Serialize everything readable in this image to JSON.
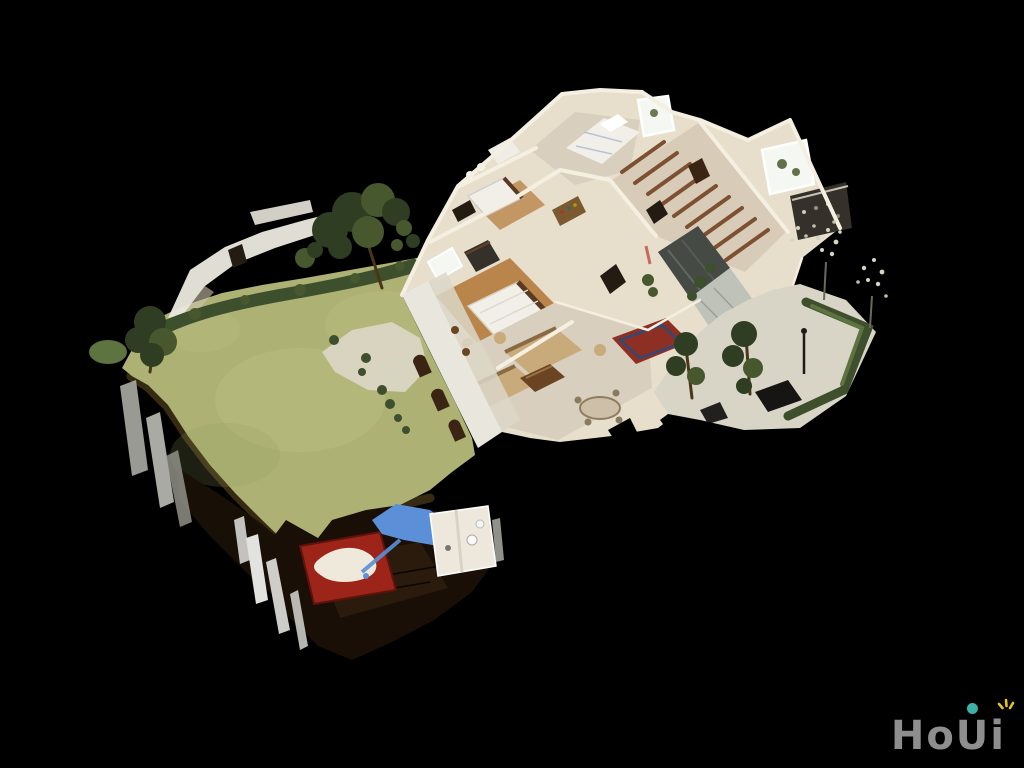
{
  "page": {
    "background": "#000000"
  },
  "viewer": {
    "scene_label": "3D dollhouse view of a scanned single-story home with backyard lawn, cutaway interior rooms and side garden",
    "regions": [
      "backyard-lawn",
      "hedgerow",
      "perimeter-wall",
      "arched-loggia",
      "master-bedroom",
      "guest-bedroom",
      "beamed-hallway",
      "mirrored-closet",
      "bathroom",
      "living-room",
      "entry-rug",
      "right-garden",
      "courtyard-tree",
      "wood-deck",
      "red-carpet",
      "blue-tarp",
      "small-bathroom"
    ]
  },
  "logo": {
    "text": "HoUi",
    "letters": [
      "H",
      "o",
      "U",
      "i"
    ]
  },
  "colors": {
    "bg": "#000000",
    "lawn": "#adb274",
    "lawn-light": "#c6c68c",
    "lawn-dark": "#8f9a58",
    "hedge": "#3d4f2c",
    "hedge-light": "#5d7340",
    "tree": "#2f3d22",
    "tree-mid": "#47582e",
    "trunk": "#4a3518",
    "wall-white": "#e9e6dd",
    "wall-cream": "#e7dfcc",
    "wall-line": "#f4efe1",
    "wall-shadow": "#cfc3ab",
    "floor-wood": "#b9854a",
    "carpet": "#d9cfbe",
    "hall-floor": "#d8ccb8",
    "stone": "#dbd7c8",
    "gravel": "#d9d5c6",
    "beam": "#7c5030",
    "bed-white": "#f1efe7",
    "sofa": "#c9aa7a",
    "sofa-dark": "#8a6a42",
    "table-wood": "#6b4423",
    "rug-red": "#8e2f23",
    "rug-blue": "#2f4a78",
    "mirror": "#454a44",
    "marble": "#bfc2b8",
    "deck": "#190f07",
    "deck-light": "#30200f",
    "soil": "#3a2c14",
    "moss": "#6a6a34",
    "red-carpet": "#9c2418",
    "blob-white": "#efe9dc",
    "tarp-blue": "#5b8fd8",
    "bath-white": "#eee8dc",
    "picket": "#e2e2de",
    "sliver-gray": "#b5b5ae",
    "window": "#f4f7f2",
    "dark-open": "#241c12",
    "door-brown": "#3a2413",
    "closet-dark": "#35302a",
    "logo-gray": "#8e8e8e",
    "logo-dot": "#3fb0a8",
    "logo-spark": "#e8c21f"
  }
}
